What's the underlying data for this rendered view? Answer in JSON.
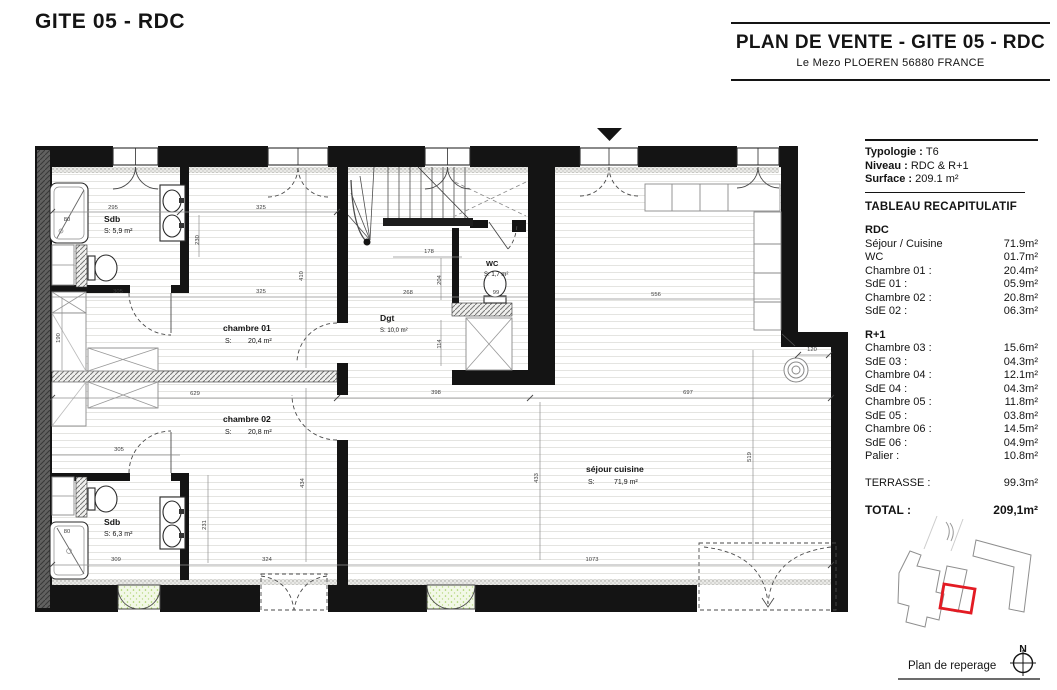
{
  "page_title": "GITE 05 - RDC",
  "title_block": {
    "title": "PLAN DE VENTE - GITE 05 - RDC",
    "subtitle": "Le Mezo PLOEREN 56880 FRANCE"
  },
  "info": {
    "rows": [
      {
        "label": "Typologie :",
        "value": "T6"
      },
      {
        "label": "Niveau :",
        "value": "RDC & R+1"
      },
      {
        "label": "Surface :",
        "value": "209.1 m²"
      }
    ],
    "recap_heading": "TABLEAU RECAPITULATIF"
  },
  "recap": {
    "sections": [
      {
        "name": "RDC",
        "rows": [
          {
            "label": "Séjour / Cuisine",
            "value": "71.9m²"
          },
          {
            "label": "WC",
            "value": "01.7m²"
          },
          {
            "label": "Chambre 01 :",
            "value": "20.4m²"
          },
          {
            "label": "SdE 01 :",
            "value": "05.9m²"
          },
          {
            "label": "Chambre 02 :",
            "value": "20.8m²"
          },
          {
            "label": "SdE 02 :",
            "value": "06.3m²"
          }
        ]
      },
      {
        "name": "R+1",
        "rows": [
          {
            "label": "Chambre 03 :",
            "value": "15.6m²"
          },
          {
            "label": "SdE 03 :",
            "value": "04.3m²"
          },
          {
            "label": "Chambre 04 :",
            "value": "12.1m²"
          },
          {
            "label": "SdE 04 :",
            "value": "04.3m²"
          },
          {
            "label": "Chambre 05 :",
            "value": "11.8m²"
          },
          {
            "label": "SdE 05 :",
            "value": "03.8m²"
          },
          {
            "label": "Chambre 06 :",
            "value": "14.5m²"
          },
          {
            "label": "SdE 06 :",
            "value": "04.9m²"
          },
          {
            "label": "Palier :",
            "value": "10.8m²"
          }
        ]
      }
    ],
    "terrasse": {
      "label": "TERRASSE :",
      "value": "99.3m²"
    },
    "total": {
      "label": "TOTAL :",
      "value": "209,1m²"
    }
  },
  "plan": {
    "rooms": {
      "sdb1": {
        "name": "Sdb",
        "area": "S: 5,9 m²"
      },
      "chambre01": {
        "name": "chambre 01",
        "area_prefix": "S:",
        "area": "20,4 m²"
      },
      "chambre02": {
        "name": "chambre 02",
        "area_prefix": "S:",
        "area": "20,8 m²"
      },
      "sdb2": {
        "name": "Sdb",
        "area": "S: 6,3 m²"
      },
      "wc": {
        "name": "WC",
        "area": "S: 1,7 m²"
      },
      "dgt": {
        "name": "Dgt",
        "area": "S: 10,0 m²"
      },
      "sejour": {
        "name": "séjour cuisine",
        "area_prefix": "S:",
        "area": "71,9 m²"
      }
    },
    "dimensions": [
      {
        "t": "295",
        "x": 113,
        "y": 209
      },
      {
        "t": "325",
        "x": 261,
        "y": 209
      },
      {
        "t": "305",
        "x": 118,
        "y": 293
      },
      {
        "t": "325",
        "x": 261,
        "y": 293
      },
      {
        "t": "268",
        "x": 408,
        "y": 294
      },
      {
        "t": "99",
        "x": 496,
        "y": 294
      },
      {
        "t": "556",
        "x": 656,
        "y": 296
      },
      {
        "t": "178",
        "x": 429,
        "y": 253
      },
      {
        "t": "230",
        "x": 199,
        "y": 240,
        "rot": true
      },
      {
        "t": "410",
        "x": 303,
        "y": 276,
        "rot": true
      },
      {
        "t": "190",
        "x": 60,
        "y": 338,
        "rot": true
      },
      {
        "t": "204",
        "x": 441,
        "y": 280,
        "rot": true
      },
      {
        "t": "114",
        "x": 441,
        "y": 344,
        "rot": true
      },
      {
        "t": "629",
        "x": 195,
        "y": 395
      },
      {
        "t": "398",
        "x": 436,
        "y": 394
      },
      {
        "t": "697",
        "x": 688,
        "y": 394
      },
      {
        "t": "120",
        "x": 812,
        "y": 351
      },
      {
        "t": "434",
        "x": 304,
        "y": 483,
        "rot": true
      },
      {
        "t": "231",
        "x": 206,
        "y": 525,
        "rot": true
      },
      {
        "t": "433",
        "x": 538,
        "y": 478,
        "rot": true
      },
      {
        "t": "519",
        "x": 751,
        "y": 457,
        "rot": true
      },
      {
        "t": "305",
        "x": 119,
        "y": 451
      },
      {
        "t": "309",
        "x": 116,
        "y": 561
      },
      {
        "t": "324",
        "x": 267,
        "y": 561
      },
      {
        "t": "1073",
        "x": 592,
        "y": 561
      },
      {
        "t": "80",
        "x": 67,
        "y": 221
      },
      {
        "t": "80",
        "x": 67,
        "y": 533
      }
    ]
  },
  "reperage": {
    "label": "Plan de reperage",
    "north": "N",
    "highlight_color": "#e31b23"
  }
}
